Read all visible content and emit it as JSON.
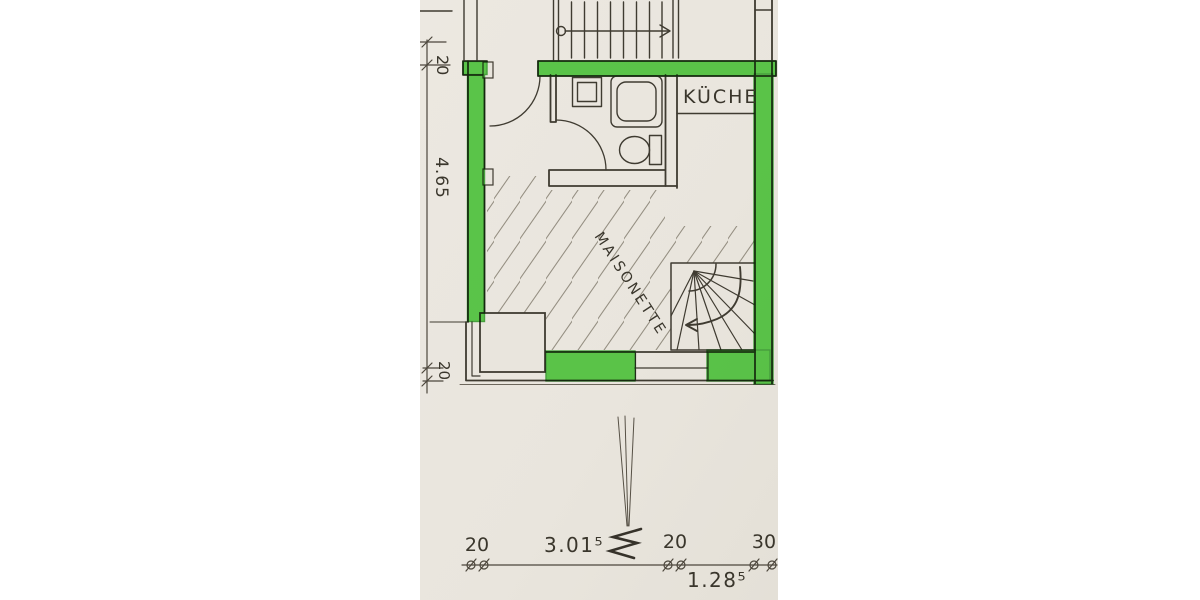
{
  "plan": {
    "labels": {
      "kitchen": "KÜCHE",
      "maisonette": "MAISONETTE"
    },
    "dimensions": {
      "left_top_wall": "20",
      "left_room_height": "4.65",
      "left_bottom_wall": "20",
      "bottom_left_wall": "20",
      "bottom_room_width": "3.01⁵",
      "bottom_mid_wall": "20",
      "bottom_right_wall": "30",
      "bottom_stair_bay_width": "1.28⁵"
    },
    "colors": {
      "paper": "#eae6de",
      "ink": "#3f3b31",
      "highlighter": "#46d335",
      "highlighter_edge": "#2da326"
    }
  }
}
